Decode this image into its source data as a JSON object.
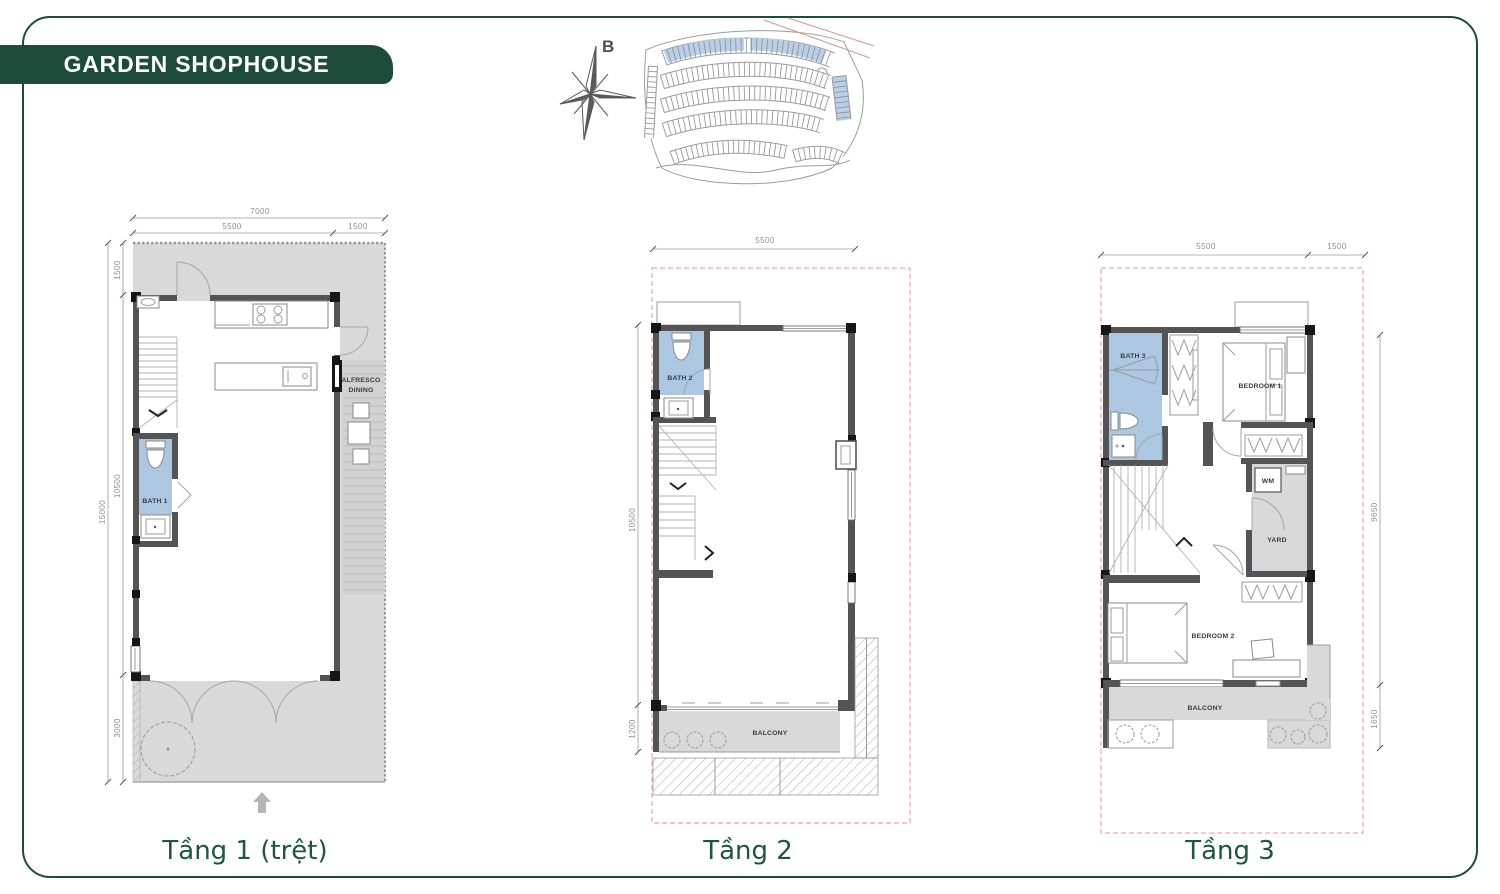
{
  "header": {
    "title": "GARDEN SHOPHOUSE"
  },
  "compass": {
    "north": "B"
  },
  "colors": {
    "brand_green": "#1d4b3a",
    "bath_blue": "#abc7e2",
    "boundary_dash_pink": "#f2a6a2"
  },
  "floor1": {
    "caption": "Tầng 1 (trệt)",
    "dims": {
      "total_w": "7000",
      "w1": "5500",
      "w2": "1500",
      "h1": "1500",
      "h2": "10500",
      "h3": "3000",
      "total_h": "15000"
    },
    "labels": {
      "bath": "BATH 1",
      "alfresco_line1": "ALFRESCO",
      "alfresco_line2": "DINING"
    }
  },
  "floor2": {
    "caption": "Tầng 2",
    "dims": {
      "w1": "5500",
      "h1": "10500",
      "h2": "1200"
    },
    "labels": {
      "bath": "BATH 2",
      "balcony": "BALCONY"
    }
  },
  "floor3": {
    "caption": "Tầng 3",
    "dims": {
      "w1": "5500",
      "w2": "1500",
      "h1": "9650",
      "h2": "1650"
    },
    "labels": {
      "bath": "BATH 3",
      "bedroom1": "BEDROOM 1",
      "bedroom2": "BEDROOM 2",
      "wm": "WM",
      "yard": "YARD",
      "balcony": "BALCONY"
    }
  }
}
